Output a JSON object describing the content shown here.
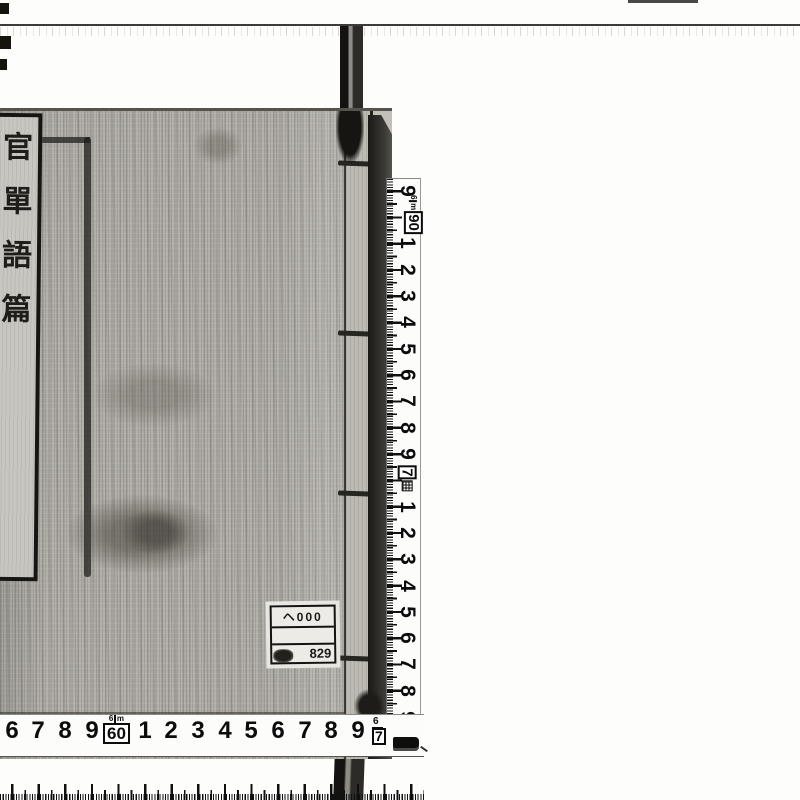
{
  "book": {
    "title_slip_characters": "官單語篇",
    "call_number_label": {
      "line1": "ヘ000",
      "line2": "",
      "line3": "829"
    }
  },
  "rulers": {
    "unit": "m",
    "horizontal": {
      "numbers_before": [
        "6",
        "7",
        "8",
        "9"
      ],
      "decade_box": {
        "meter_digit": "6",
        "unit": "m",
        "value": "60"
      },
      "numbers_after": [
        "1",
        "2",
        "3",
        "4",
        "5",
        "6",
        "7",
        "8",
        "9"
      ],
      "end_mark": {
        "meter_digit": "6",
        "value": "7"
      }
    },
    "vertical": {
      "number_top": "9",
      "decade_box": {
        "meter_digit": "6",
        "unit": "m",
        "value": "90"
      },
      "numbers_mid": [
        "1",
        "2",
        "3",
        "4",
        "5",
        "6",
        "7",
        "8",
        "9"
      ],
      "meter_box": {
        "value": "7"
      },
      "numbers_bottom": [
        "1",
        "2",
        "3",
        "4",
        "5",
        "6",
        "7",
        "8",
        "9"
      ]
    }
  }
}
